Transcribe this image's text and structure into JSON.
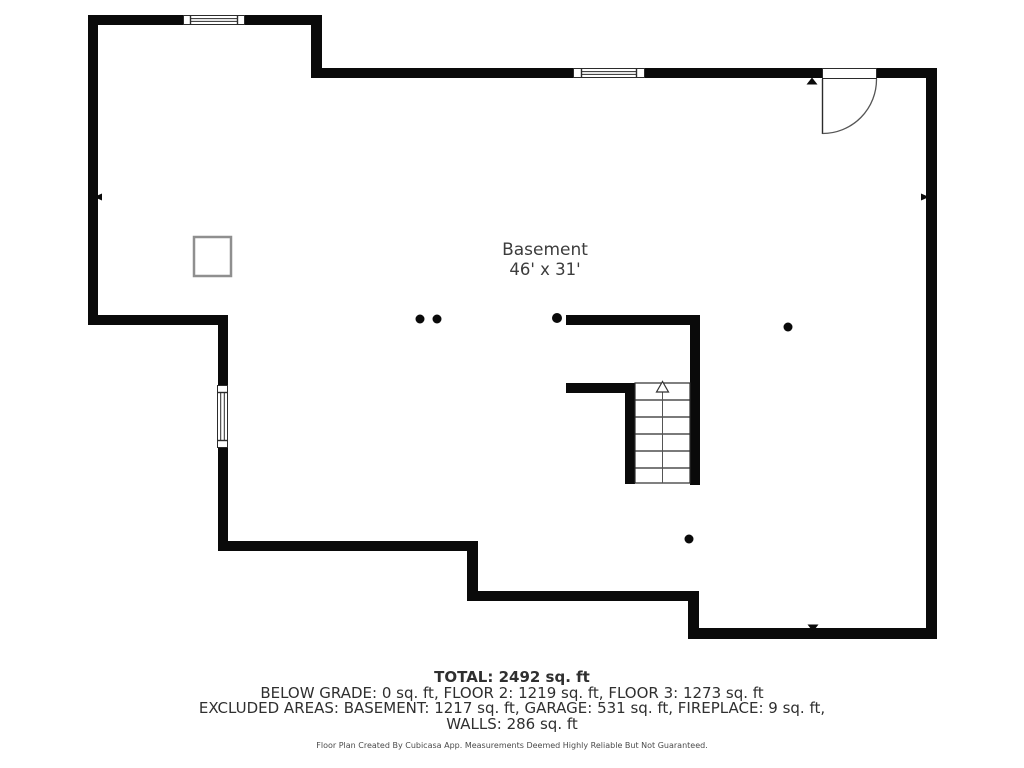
{
  "floor_plan": {
    "room_label": "Basement",
    "room_dimensions": "46' x 31'"
  },
  "summary": {
    "total_line": "TOTAL: 2492 sq. ft",
    "grade_line": "BELOW GRADE: 0 sq. ft, FLOOR 2: 1219 sq. ft, FLOOR 3: 1273 sq. ft",
    "excluded_line": "EXCLUDED AREAS: BASEMENT: 1217 sq. ft, GARAGE: 531 sq. ft, FIREPLACE: 9 sq. ft,",
    "walls_line": "WALLS: 286 sq. ft"
  },
  "footer_note": "Floor Plan Created By Cubicasa App. Measurements Deemed Highly Reliable But Not Guaranteed.",
  "colors": {
    "wall": "#0a0a0a",
    "thin_line": "#2b2b2b",
    "fixture_outline": "#8f8f8f",
    "label_text": "#3c3c3c"
  }
}
